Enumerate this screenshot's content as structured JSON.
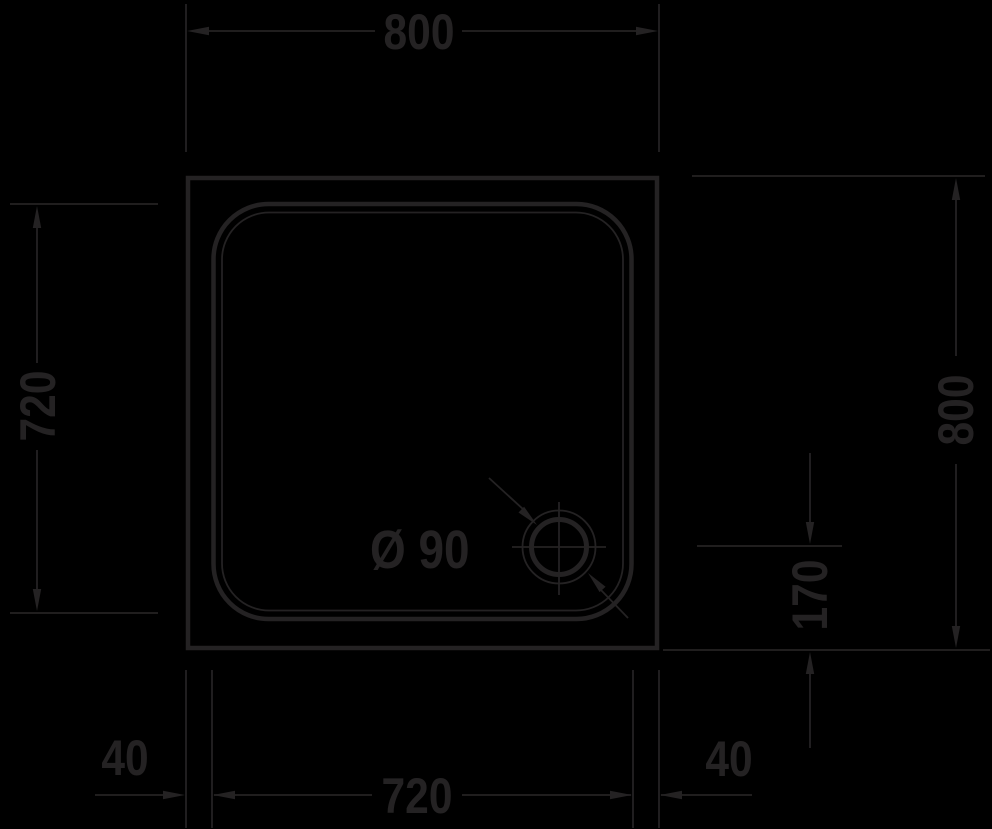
{
  "drawing": {
    "description": "Square shower tray plan view technical drawing",
    "background_color": "#000000",
    "line_color": "#242223",
    "dimensions": {
      "top_width": "800",
      "left_inner_height": "720",
      "right_height": "800",
      "drain_offset": "170",
      "bottom_left_margin": "40",
      "bottom_inner_width": "720",
      "bottom_right_margin": "40",
      "drain_diameter": "Ø 90"
    }
  }
}
